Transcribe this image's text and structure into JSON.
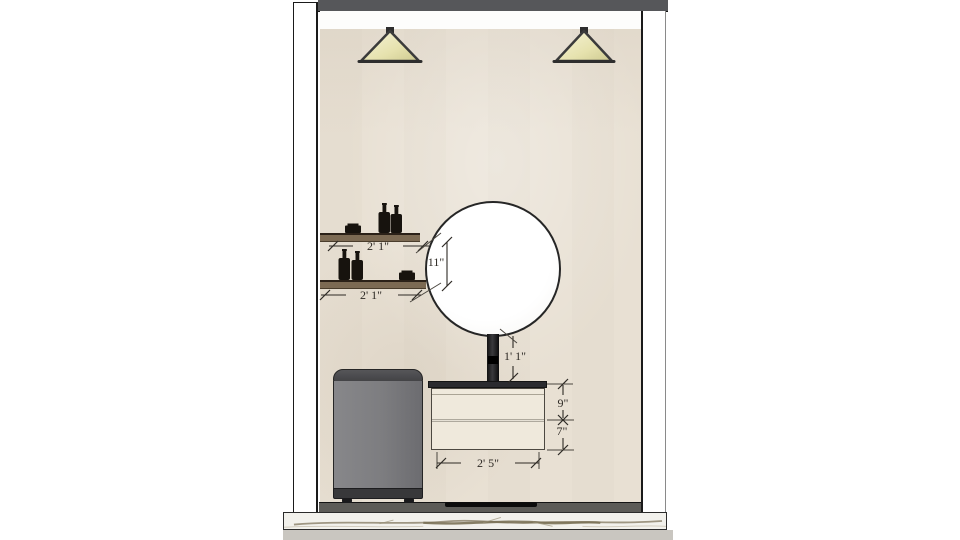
{
  "scene": {
    "type": "bathroom-interior-elevation-drawing",
    "dimensions": {
      "upper_shelf_width": "2' 1\"",
      "lower_shelf_width": "2' 1\"",
      "shelf_vertical_gap": "11\"",
      "mirror_to_counter_height": "1' 1\"",
      "top_drawer_height": "9\"",
      "bottom_drawer_height": "7\"",
      "vanity_width": "2' 5\""
    },
    "colors": {
      "wall": "#e8e0d3",
      "ceiling_band": "#56575a",
      "shelf_wood": "#7c6a53",
      "lamp_shade": "#e9e5b4",
      "vanity_body": "#efe9dc",
      "vanity_counter": "#2b2b2f",
      "washer_body": "#7d7d80",
      "floor_line": "#5c5b57",
      "marble": "#f2f1ec",
      "dimension_text": "#2e2a25"
    }
  }
}
